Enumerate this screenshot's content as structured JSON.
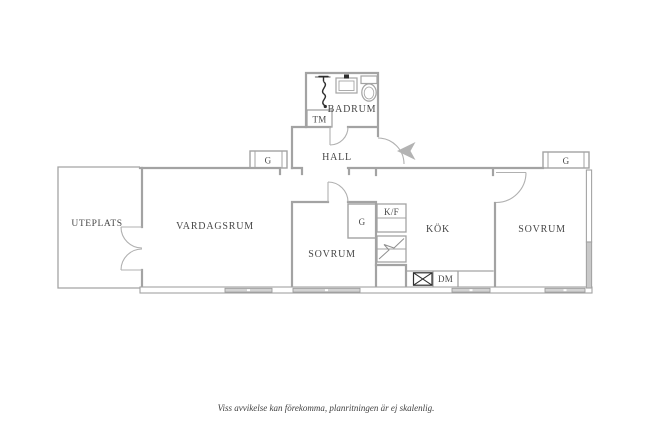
{
  "rooms": {
    "uteplats": {
      "label": "UTEPLATS"
    },
    "vardagsrum": {
      "label": "VARDAGSRUM"
    },
    "sovrum1": {
      "label": "SOVRUM"
    },
    "hall": {
      "label": "HALL"
    },
    "badrum": {
      "label": "BADRUM"
    },
    "kok": {
      "label": "KÖK"
    },
    "sovrum2": {
      "label": "SOVRUM"
    }
  },
  "fixtures": {
    "washing_machine": {
      "label": "TM"
    },
    "closet_hall": {
      "label": "G"
    },
    "closet_sovrum1": {
      "label": "G"
    },
    "closet_sovrum2": {
      "label": "G"
    },
    "fridge_freezer": {
      "label": "K/F"
    },
    "dishwasher": {
      "label": "DM"
    }
  },
  "footer": {
    "disclaimer": "Viss avvikelse kan förekomma, planritningen är ej skalenlig."
  },
  "colors": {
    "wall": "#a3a3a3",
    "wall_fill": "#c9c9c9",
    "window_fill": "#d2d2d2",
    "label_text": "#474747",
    "arrow": "#b3b3b3",
    "fixture_dark": "#2e2e2e",
    "background": "#ffffff"
  }
}
